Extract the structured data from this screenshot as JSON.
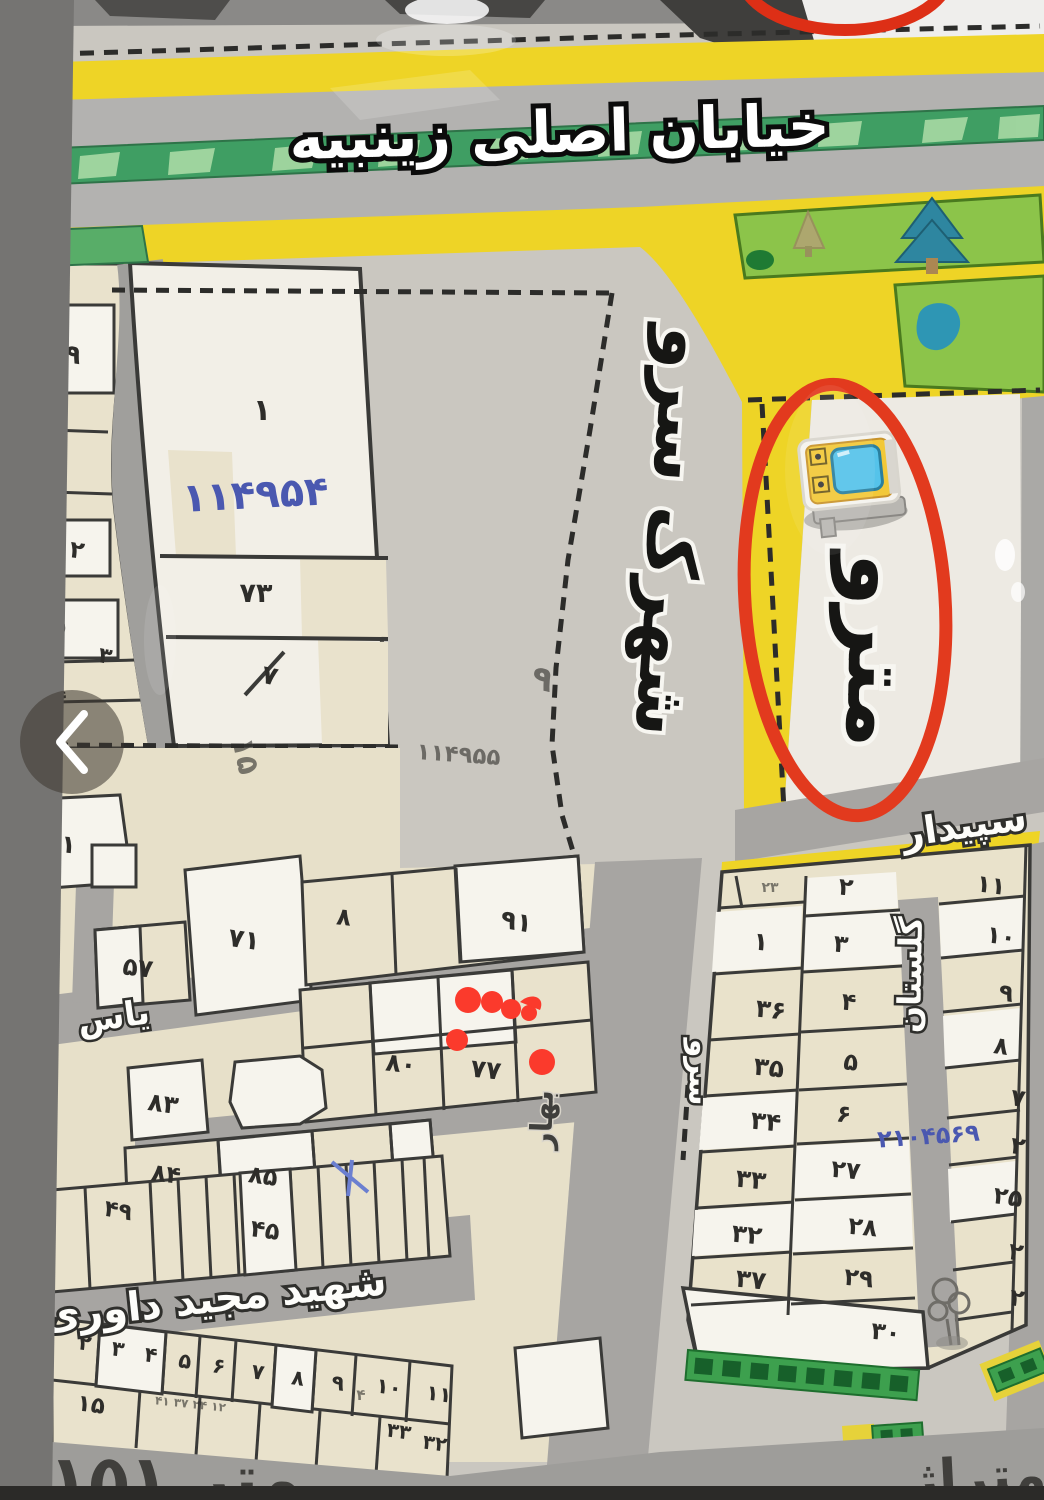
{
  "map": {
    "title": "خیابان اصلی زینبیه",
    "metro_label": "مترو",
    "streets": {
      "shahrak_sarv": "شهرک سرو",
      "sepidar": "سپیدار",
      "golestan": "گلستان",
      "sarv": "سرو",
      "bahar": "بهار",
      "yas": "یاس",
      "davari": "شهید مجید داوری"
    },
    "caption": {
      "label": "متراژ",
      "value": "۱۵۱ متر"
    },
    "codes": {
      "block1": "۱۱۴۹۵۴",
      "right_block": "۲۱۰۴۵۶۹",
      "corner": "۴۹"
    },
    "parcels": {
      "left_strip": [
        "۱۹",
        "۲۰",
        "۲",
        "۵",
        "۳",
        "۴"
      ],
      "block1": [
        "۱",
        "۷۳",
        "۷"
      ],
      "mid": [
        "۶۱",
        "۵۷",
        "۷۱",
        "۸",
        "۹۱",
        "۸۰",
        "۷۷",
        "۸۳",
        "۸۴",
        "۸۵",
        "۵۰",
        "۴۹",
        "۴۵"
      ],
      "bottom_row": [
        "۲",
        "۳",
        "۴",
        "۵",
        "۶",
        "۷",
        "۸",
        "۹",
        "۱۰",
        "۱۱"
      ],
      "bottom_extra": [
        "۱۵",
        "۴",
        "۳۳",
        "۳۲"
      ],
      "bottom_small_row": "۴۱ ۳۷ ۲۴ ۱۲",
      "faint": {
        "a": "۱۵",
        "b": "۹",
        "c": "۱۱۴۹۵۵"
      },
      "right_a": [
        "۲۳",
        "۱",
        "۳۶",
        "۳۵",
        "۳۴",
        "۳۳",
        "۳۲",
        "۳۷"
      ],
      "right_b": [
        "۲",
        "۳",
        "۴",
        "۵",
        "۶",
        "۲۷",
        "۲۸",
        "۲۹",
        "۳۰"
      ],
      "right_c": [
        "۱۱",
        "۱۰",
        "۹",
        "۸",
        "۷",
        "۲",
        "۲۵",
        "۲",
        "۲"
      ]
    },
    "colors": {
      "highlight_red": "#e23a1e",
      "street_yellow": "#eed426",
      "handwriting_blue": "#4a58b0",
      "park_green": "#8cc44a"
    }
  },
  "overlay": {
    "prev_icon": "chevron-left"
  }
}
